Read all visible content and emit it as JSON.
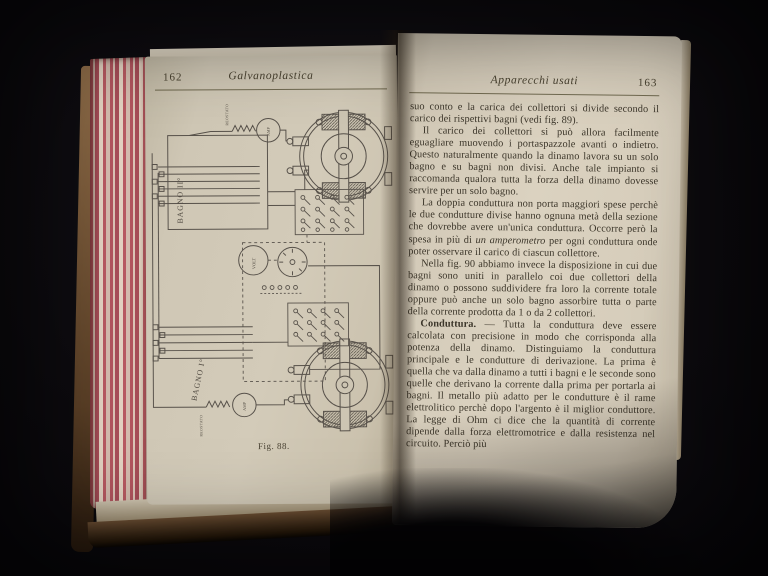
{
  "book": {
    "left_page": {
      "page_number": "162",
      "running_header": "Galvanoplastica",
      "figure": {
        "caption": "Fig. 88.",
        "labels": {
          "bath2": "BAGNO II°",
          "bath1": "BAGNO I°",
          "ammeter_top": "AMP",
          "ammeter_bottom": "AMP",
          "voltmeter": "VOLT",
          "rheostat_top": "REOSTATO",
          "rheostat_bottom": "REOSTATO"
        }
      }
    },
    "right_page": {
      "running_header": "Apparecchi usati",
      "page_number": "163",
      "paragraphs": [
        {
          "text": "suo conto e la carica dei collettori si divide secondo il carico dei rispettivi bagni (vedi fig. 89)."
        },
        {
          "text": "Il carico dei collettori si può allora facilmente eguagliare muovendo i portaspazzole avanti o indietro. Questo naturalmente quando la dinamo lavora su un solo bagno e su bagni non divisi. Anche tale impianto si raccomanda qualora tutta la forza della dinamo dovesse servire per un solo bagno."
        },
        {
          "before_italic": "La doppia conduttura non porta maggiori spese perchè le due condutture divise hanno ognuna metà della sezione che dovrebbe avere un'unica conduttura. Occorre però la spesa in più di ",
          "italic": "un amperometro",
          "after_italic": " per ogni conduttura onde poter osservare il carico di ciascun collettore."
        },
        {
          "text": "Nella fig. 90 abbiamo invece la disposizione in cui due bagni sono uniti in parallelo coi due collettori della dinamo o possono suddividere fra loro la corrente totale oppure può anche un solo bagno assorbire tutta o parte della corrente prodotta da 1 o da 2 collettori."
        },
        {
          "lead": "Conduttura.",
          "separator": " — ",
          "text": "Tutta la conduttura deve essere calcolata con precisione in modo che corrisponda alla potenza della dinamo. Distinguiamo la conduttura principale e le condutture di derivazione. La prima è quella che va dalla dinamo a tutti i bagni e le seconde sono quelle che derivano la corrente dalla prima per portarla ai bagni. Il metallo più adatto per le condutture è il rame elettrolitico perchè dopo l'argento è il miglior conduttore. La legge di Ohm ci dice che la quantità di corrente dipende dalla forza elettromotrice e dalla resistenza nel circuito. Perciò più"
        }
      ]
    },
    "colors": {
      "background": "#0d0b0f",
      "page_left": "#cdc5b3",
      "page_right": "#d8cfbd",
      "ink": "#3c362a",
      "edge_stripes_red": "#b2555e",
      "cover_brown": "#6b4e33"
    }
  }
}
